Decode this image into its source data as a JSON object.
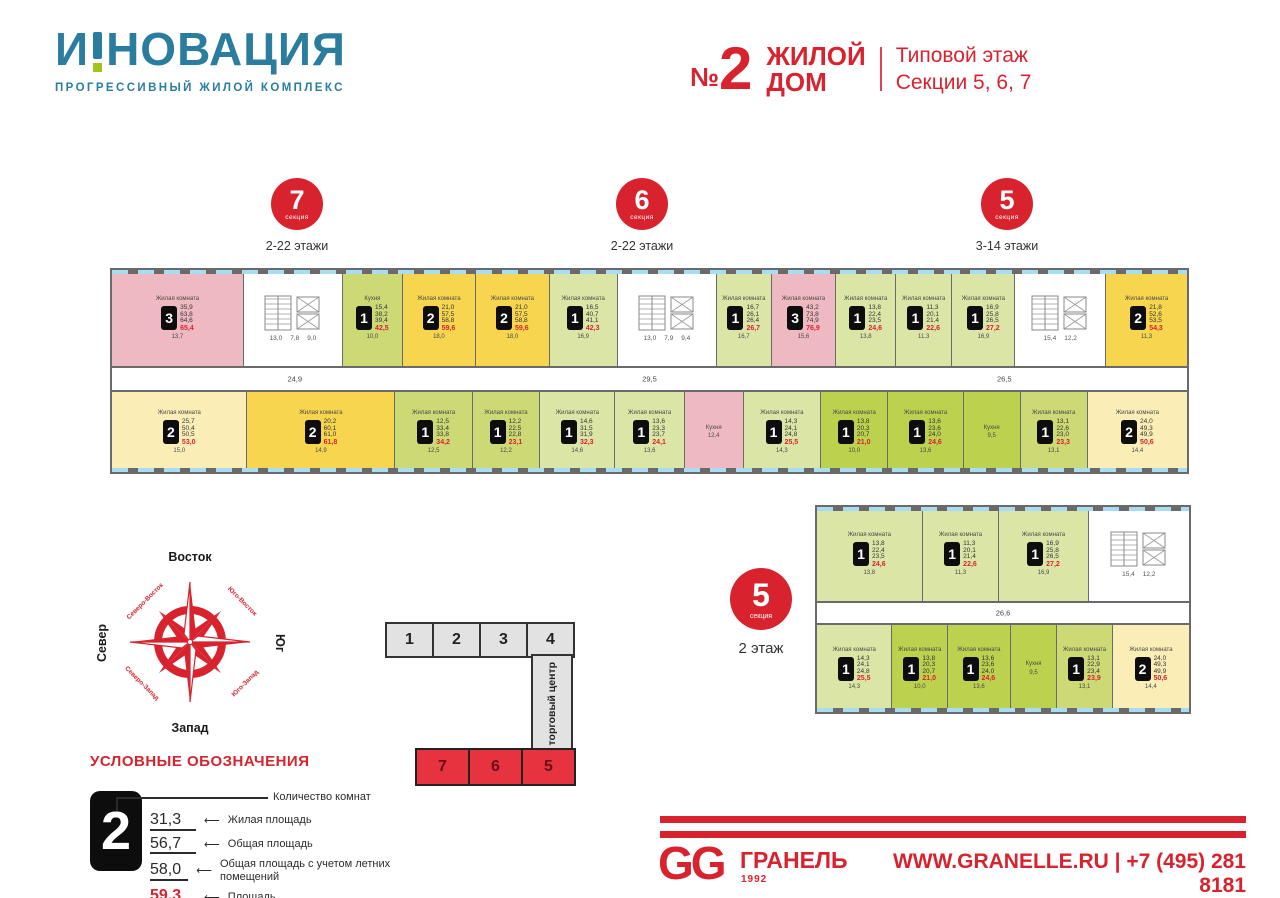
{
  "header": {
    "logo_part1": "И",
    "logo_part2": "НОВАЦИЯ",
    "tagline": "ПРОГРЕССИВНЫЙ ЖИЛОЙ КОМПЛЕКС",
    "building_no_sign": "№",
    "building_no": "2",
    "building_line1": "ЖИЛОЙ",
    "building_line2": "ДОМ",
    "subtitle_line1": "Типовой этаж",
    "subtitle_line2": "Секции 5, 6, 7"
  },
  "colors": {
    "accent_red": "#d8232f",
    "logo_teal": "#2b7da0",
    "logo_green": "#a2c617",
    "apt_pink": "#efb9c1",
    "apt_yellow": "#f7d54e",
    "apt_pale_yellow": "#faeeb6",
    "apt_lime": "#ccd974",
    "apt_light_green": "#dbe6a6",
    "apt_olive": "#bcd14e",
    "window_blue": "#a9dcf1",
    "wall_gray": "#6a6a6a"
  },
  "section_badges": [
    {
      "num": "7",
      "label": "секция",
      "floors": "2-22 этажи"
    },
    {
      "num": "6",
      "label": "секция",
      "floors": "2-22 этажи"
    },
    {
      "num": "5",
      "label": "секция",
      "floors": "3-14 этажи"
    }
  ],
  "plan": {
    "corridor_labels": [
      "24,9",
      "29,5",
      "26,5"
    ],
    "top": [
      {
        "kind": "apt",
        "color": "pink",
        "rooms": "3",
        "room": "Жилая комната",
        "areas": [
          "35,9",
          "63,8",
          "64,6"
        ],
        "area": "65,4",
        "dim": "13,7",
        "w": 150
      },
      {
        "kind": "core",
        "dims": [
          "13,0",
          "7,8",
          "9,0"
        ],
        "w": 112
      },
      {
        "kind": "apt",
        "color": "lime",
        "rooms": "1",
        "room": "Кухня",
        "areas": [
          "15,4",
          "38,2",
          "39,4"
        ],
        "area": "42,5",
        "dim": "10,0",
        "w": 66
      },
      {
        "kind": "apt",
        "color": "yellow",
        "rooms": "2",
        "room": "Жилая комната",
        "areas": [
          "21,0",
          "57,5",
          "58,8"
        ],
        "area": "59,6",
        "dim": "18,0",
        "w": 82
      },
      {
        "kind": "apt",
        "color": "yellow",
        "rooms": "2",
        "room": "Жилая комната",
        "areas": [
          "21,0",
          "57,5",
          "58,8"
        ],
        "area": "59,6",
        "dim": "18,0",
        "w": 82
      },
      {
        "kind": "apt",
        "color": "lgreen",
        "rooms": "1",
        "room": "Жилая комната",
        "areas": [
          "16,5",
          "40,7",
          "41,1"
        ],
        "area": "42,3",
        "dim": "16,9",
        "w": 76
      },
      {
        "kind": "core",
        "dims": [
          "13,0",
          "7,9",
          "9,4"
        ],
        "w": 112
      },
      {
        "kind": "apt",
        "color": "lgreen",
        "rooms": "1",
        "room": "Жилая комната",
        "areas": [
          "16,7",
          "26,1",
          "26,4"
        ],
        "area": "26,7",
        "dim": "16,7",
        "w": 60
      },
      {
        "kind": "apt",
        "color": "pink",
        "rooms": "3",
        "room": "Жилая комната",
        "areas": [
          "43,2",
          "73,8",
          "74,9"
        ],
        "area": "76,9",
        "dim": "15,6",
        "w": 72
      },
      {
        "kind": "apt",
        "color": "lgreen",
        "rooms": "1",
        "room": "Жилая комната",
        "areas": [
          "13,8",
          "22,4",
          "23,5"
        ],
        "area": "24,6",
        "dim": "13,8",
        "w": 66
      },
      {
        "kind": "apt",
        "color": "lgreen",
        "rooms": "1",
        "room": "Жилая комната",
        "areas": [
          "11,3",
          "20,1",
          "21,4"
        ],
        "area": "22,6",
        "dim": "11,3",
        "w": 62
      },
      {
        "kind": "apt",
        "color": "lgreen",
        "rooms": "1",
        "room": "Жилая комната",
        "areas": [
          "16,9",
          "25,8",
          "26,5"
        ],
        "area": "27,2",
        "dim": "16,9",
        "w": 70
      },
      {
        "kind": "core",
        "dims": [
          "15,4",
          "12,2"
        ],
        "w": 102
      },
      {
        "kind": "apt",
        "color": "yellow",
        "rooms": "2",
        "room": "Жилая комната",
        "areas": [
          "21,8",
          "52,6",
          "53,5"
        ],
        "area": "54,3",
        "dim": "11,3",
        "w": 92
      }
    ],
    "bottom": [
      {
        "kind": "apt",
        "color": "pale",
        "rooms": "2",
        "room": "Жилая комната",
        "areas": [
          "25,7",
          "50,4",
          "50,5"
        ],
        "area": "53,0",
        "dim": "15,0",
        "w": 128
      },
      {
        "kind": "apt",
        "color": "yellow",
        "rooms": "2",
        "room": "Жилая комната",
        "areas": [
          "20,2",
          "60,1",
          "61,0"
        ],
        "area": "61,8",
        "dim": "14,9",
        "w": 140
      },
      {
        "kind": "apt",
        "color": "lime",
        "rooms": "1",
        "room": "Жилая комната",
        "areas": [
          "12,5",
          "33,4",
          "33,8"
        ],
        "area": "34,2",
        "dim": "12,5",
        "w": 72
      },
      {
        "kind": "apt",
        "color": "lime",
        "rooms": "1",
        "room": "Жилая комната",
        "areas": [
          "12,2",
          "22,5",
          "22,8"
        ],
        "area": "23,1",
        "dim": "12,2",
        "w": 62
      },
      {
        "kind": "apt",
        "color": "lgreen",
        "rooms": "1",
        "room": "Жилая комната",
        "areas": [
          "14,6",
          "31,5",
          "31,9"
        ],
        "area": "32,3",
        "dim": "14,6",
        "w": 70
      },
      {
        "kind": "apt",
        "color": "lgreen",
        "rooms": "1",
        "room": "Жилая комната",
        "areas": [
          "13,6",
          "23,3",
          "23,7"
        ],
        "area": "24,1",
        "dim": "13,6",
        "w": 64
      },
      {
        "kind": "part",
        "color": "pink",
        "room": "Кухня",
        "dim": "12,4",
        "w": 54
      },
      {
        "kind": "apt",
        "color": "lgreen",
        "rooms": "1",
        "room": "Жилая комната",
        "areas": [
          "14,3",
          "24,1",
          "24,8"
        ],
        "area": "25,5",
        "dim": "14,3",
        "w": 72
      },
      {
        "kind": "apt",
        "color": "olive",
        "rooms": "1",
        "room": "Жилая комната",
        "areas": [
          "13,8",
          "20,3",
          "20,7"
        ],
        "area": "21,0",
        "dim": "10,0",
        "w": 62
      },
      {
        "kind": "apt",
        "color": "olive",
        "rooms": "1",
        "room": "Жилая комната",
        "areas": [
          "13,6",
          "23,6",
          "24,0"
        ],
        "area": "24,6",
        "dim": "13,6",
        "w": 70
      },
      {
        "kind": "part",
        "color": "olive",
        "room": "Кухня",
        "dim": "9,5",
        "w": 52
      },
      {
        "kind": "apt",
        "color": "lime",
        "rooms": "1",
        "room": "Жилая комната",
        "areas": [
          "13,1",
          "22,6",
          "23,0"
        ],
        "area": "23,3",
        "dim": "13,1",
        "w": 62
      },
      {
        "kind": "apt",
        "color": "pale",
        "rooms": "2",
        "room": "Жилая комната",
        "areas": [
          "24,0",
          "49,3",
          "49,9"
        ],
        "area": "50,6",
        "dim": "14,4",
        "w": 94
      }
    ]
  },
  "floor2": {
    "badge": {
      "num": "5",
      "label": "секция"
    },
    "floor_label": "2 этаж",
    "corridor_labels": [
      "26,6"
    ],
    "top": [
      {
        "kind": "apt",
        "color": "lgreen",
        "rooms": "1",
        "room": "Жилая комната",
        "areas": [
          "13,8",
          "22,4",
          "23,5"
        ],
        "area": "24,6",
        "dim": "13,8",
        "w": 100
      },
      {
        "kind": "apt",
        "color": "lgreen",
        "rooms": "1",
        "room": "Жилая комната",
        "areas": [
          "11,3",
          "20,1",
          "21,4"
        ],
        "area": "22,6",
        "dim": "11,3",
        "w": 72
      },
      {
        "kind": "apt",
        "color": "lgreen",
        "rooms": "1",
        "room": "Жилая комната",
        "areas": [
          "16,9",
          "25,8",
          "26,5"
        ],
        "area": "27,2",
        "dim": "16,9",
        "w": 84
      },
      {
        "kind": "core",
        "dims": [
          "15,4",
          "12,2"
        ],
        "w": 96
      }
    ],
    "bottom": [
      {
        "kind": "apt",
        "color": "lgreen",
        "rooms": "1",
        "room": "Жилая комната",
        "areas": [
          "14,3",
          "24,1",
          "24,8"
        ],
        "area": "25,5",
        "dim": "14,3",
        "w": 80
      },
      {
        "kind": "apt",
        "color": "olive",
        "rooms": "1",
        "room": "Жилая комната",
        "areas": [
          "13,8",
          "20,3",
          "20,7"
        ],
        "area": "21,0",
        "dim": "10,0",
        "w": 58
      },
      {
        "kind": "apt",
        "color": "olive",
        "rooms": "1",
        "room": "Жилая комната",
        "areas": [
          "13,6",
          "23,6",
          "24,0"
        ],
        "area": "24,6",
        "dim": "13,6",
        "w": 66
      },
      {
        "kind": "part",
        "color": "olive",
        "room": "Кухня",
        "dim": "9,5",
        "w": 48
      },
      {
        "kind": "apt",
        "color": "lime",
        "rooms": "1",
        "room": "Жилая комната",
        "areas": [
          "13,1",
          "22,9",
          "23,4"
        ],
        "area": "23,9",
        "dim": "13,1",
        "w": 58
      },
      {
        "kind": "apt",
        "color": "pale",
        "rooms": "2",
        "room": "Жилая комната",
        "areas": [
          "24,0",
          "49,3",
          "49,9"
        ],
        "area": "50,6",
        "dim": "14,4",
        "w": 82
      }
    ]
  },
  "compass": {
    "east": "Восток",
    "west": "Запад",
    "north": "Север",
    "south": "Юг",
    "ne": "Северо-Восток",
    "se": "Юго-Восток",
    "nw": "Северо-Запад",
    "sw": "Юго-Запад"
  },
  "schematic": {
    "gray_sections": [
      "1",
      "2",
      "3",
      "4"
    ],
    "mall_label": "торговый центр",
    "red_sections": [
      "7",
      "6",
      "5"
    ]
  },
  "legend": {
    "title": "УСЛОВНЫЕ ОБОЗНАЧЕНИЯ",
    "sample_rooms": "2",
    "rooms_label": "Количество комнат",
    "arrow": "⟵",
    "rows": [
      {
        "value": "31,3",
        "label": "Жилая площадь",
        "red": false
      },
      {
        "value": "56,7",
        "label": "Общая площадь",
        "red": false
      },
      {
        "value": "58,0",
        "label": "Общая площадь с учетом летних помещений",
        "red": false
      },
      {
        "value": "59,3",
        "label": "Площадь",
        "red": true
      }
    ]
  },
  "footer": {
    "logo": "GG",
    "brand": "ГРАНЕЛЬ",
    "year": "1992",
    "contacts": "WWW.GRANELLE.RU | +7 (495) 281 8181"
  }
}
